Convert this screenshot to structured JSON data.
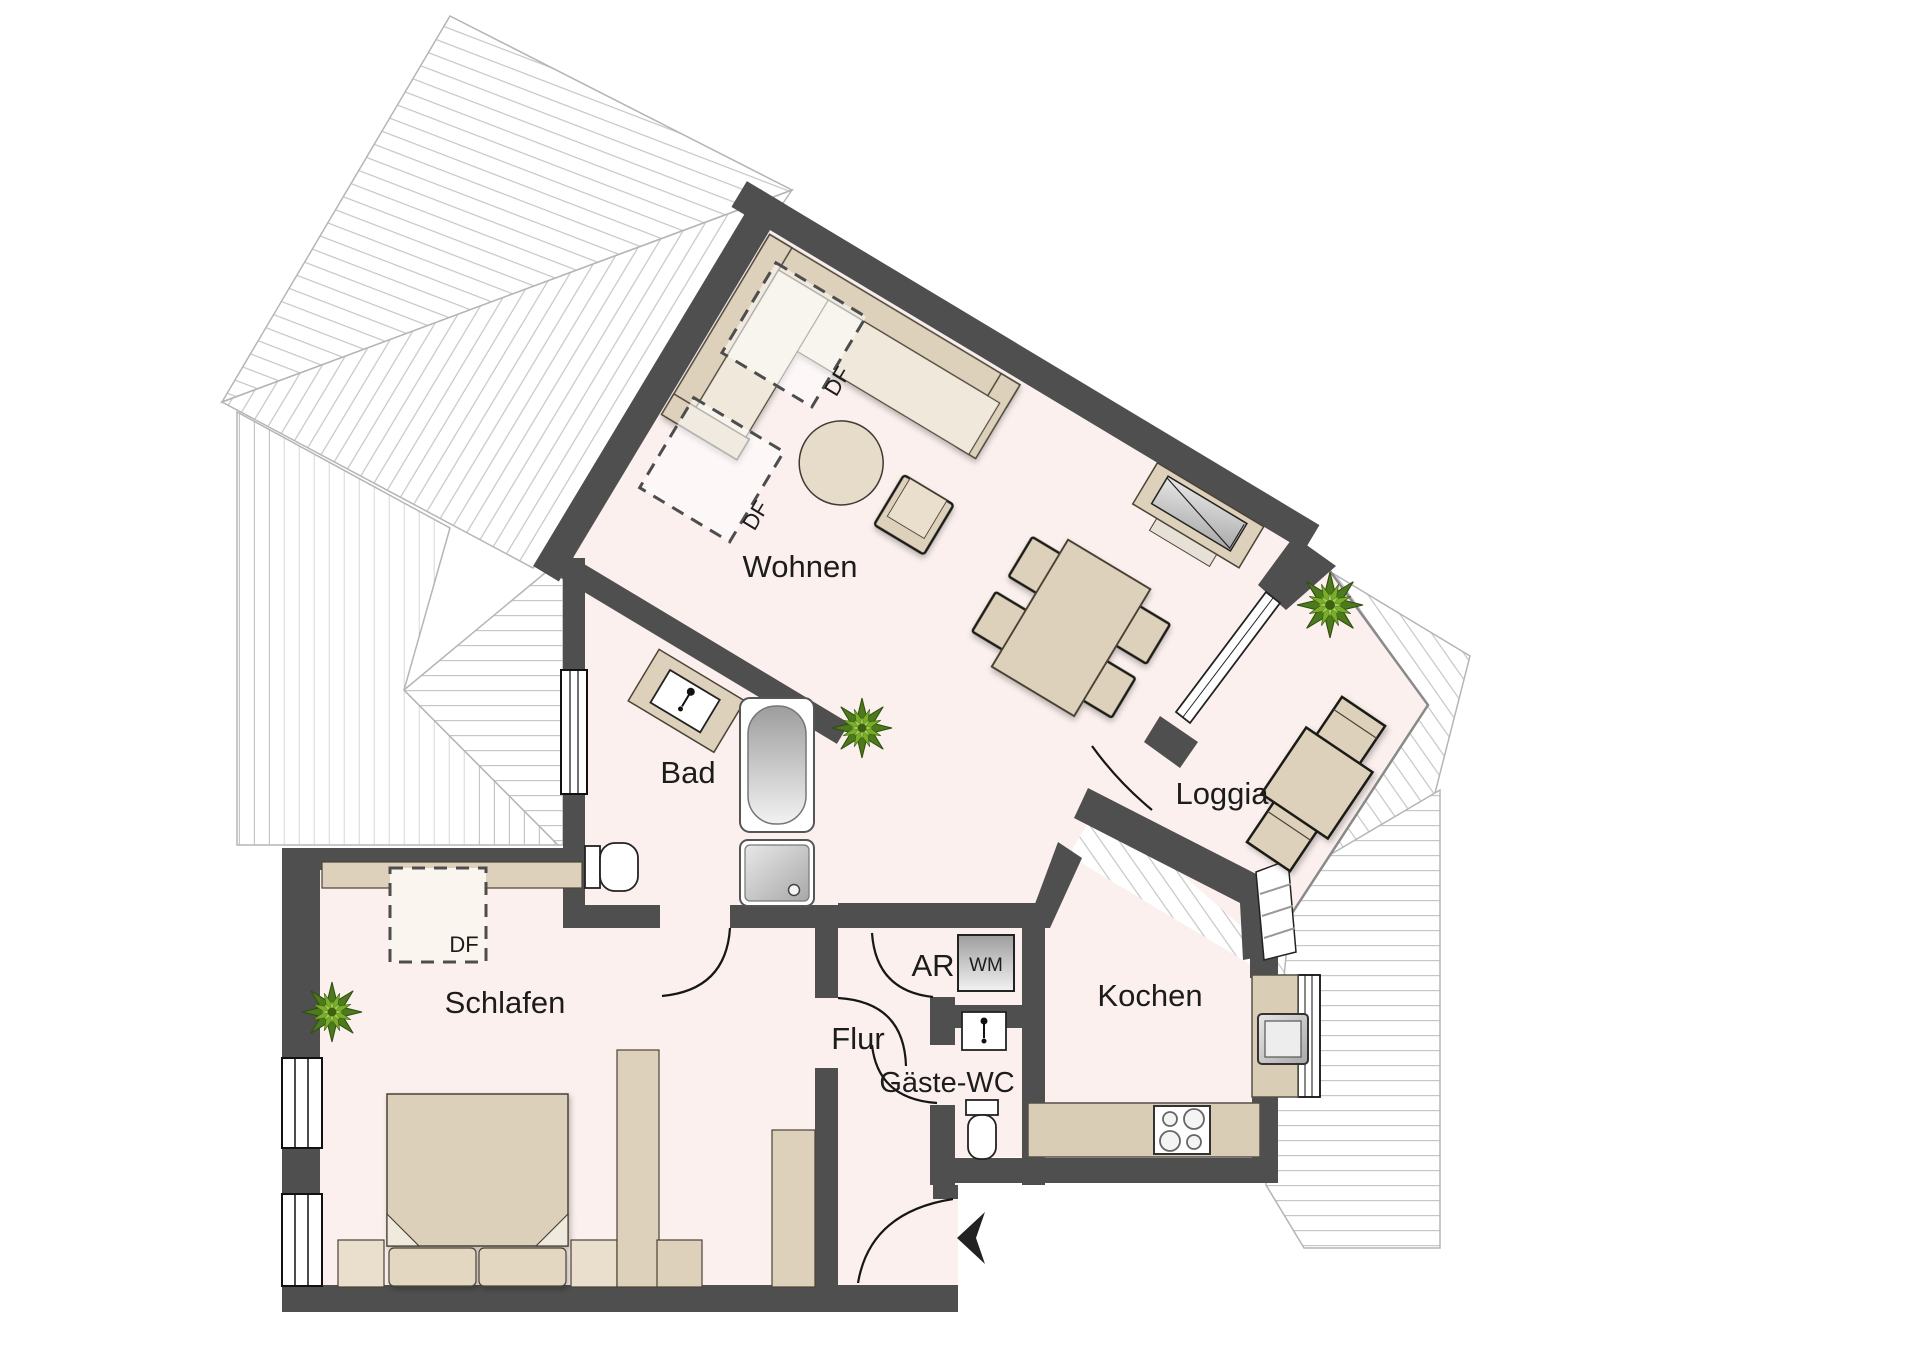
{
  "plan": {
    "rooms": {
      "living": "Wohnen",
      "bath": "Bad",
      "bedroom": "Schlafen",
      "hall": "Flur",
      "guest_wc": "Gäste-WC",
      "storage": "AR",
      "kitchen": "Kochen",
      "loggia": "Loggia"
    },
    "markers": {
      "roof_window": "DF",
      "washing_machine": "WM"
    },
    "colors": {
      "wall": "#4f4f4f",
      "floor": "#fbf0ee",
      "furniture": "#ddd1bb",
      "furniture_light": "#efe8db",
      "counter": "#d9cdb5",
      "plant_green": "#76aa28",
      "roof_hatch": "#c6c6c6"
    }
  }
}
